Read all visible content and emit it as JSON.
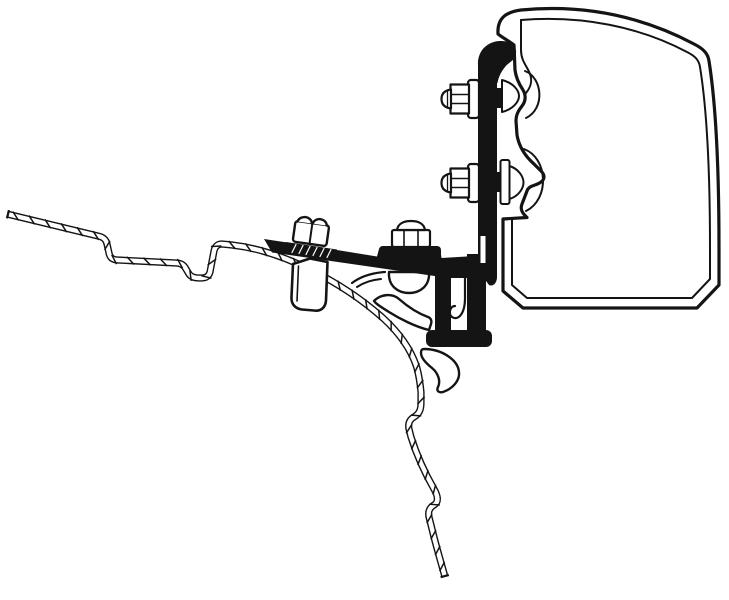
{
  "canvas": {
    "width": 729,
    "height": 600,
    "background": "#ffffff",
    "ink": "#141414",
    "paper": "#ffffff"
  },
  "diagram": {
    "type": "technical-line-drawing",
    "subject": "awning-adapter-bracket-cross-section",
    "hatch": {
      "spacing": 16.5,
      "tick_length": 10.5,
      "tick_width": 1.5,
      "outer_width": 7.2,
      "inner_width": 4.4,
      "cap_length": 8.5,
      "cap_width": 2.2
    },
    "parts": [
      {
        "name": "awning-cassette-outer-profile",
        "kind": "path",
        "fill": "paper",
        "sw": 3.2,
        "d": "M 498 34 C 497 18 506 12 521 10 C 585 4 643 17 694 44 C 704 49 708 54 709 61 C 716 105 719 168 719 248 L 719 285 L 697 308 L 523 308 L 503 291 L 503 219 L 527 217.5 C 522 213 520 209 522 204 L 527 191 C 529 185 536 186 541 182 C 545 179 545 175 541 171 L 534 164 C 525 156 519 147 517 135 L 516 121 C 516 114 519 110 522 106 C 526 101 526 95 523 90 C 519 84 516 78 515 70 L 514 45 C 509 41 503 38 498 34 Z"
      },
      {
        "name": "awning-cassette-inner-line",
        "kind": "path",
        "sw": 2,
        "d": "M 521 20 C 582 15 640 27 687 52 C 695 56 699 60 700 67 C 707 110 710 168 710 248 L 710 279 L 692 298 L 527 298 L 512 285 L 512 220"
      },
      {
        "name": "awning-cassette-left-inner-top-line",
        "kind": "path",
        "sw": 2,
        "d": "M 521 20 L 521 50 C 521 61 527 66 530 74 C 533 82 530 88 526 93"
      },
      {
        "name": "awning-rail-rib-upper",
        "kind": "path",
        "sw": 2,
        "d": "M 525 71 C 543 78 545 109 526 118"
      },
      {
        "name": "awning-rail-rib-lower",
        "kind": "path",
        "sw": 2,
        "d": "M 524 149 C 548 158 550 199 526 211"
      },
      {
        "name": "vehicle-roof-sheet-profile",
        "kind": "hatched",
        "d": "M 7 214 L 98 236 C 103 237 106 239 107 244 L 109 253 C 110 258 113 260 118 260 L 176 263 C 181 263 184 265 186 269 L 189 274 C 191 277 195 278 199 278 L 202 278 C 206 278 209 276 210 272 L 214 251 C 215 246 218 244 222 244 L 232 245 C 258 248 285 257 311 270 C 337 283 363 300 384 319 C 398 332 410 348 416 365 C 419 374 420 382 421 392 L 421 403 C 421 410 419 414 414 417 C 409 420 408 424 409 429 L 411 437 C 417 456 426 475 434 489 C 438 496 439 502 434 505 C 429 508 428 512 429 517 L 432 529 C 436 546 441 562 445 577"
      },
      {
        "name": "rail-bolt-shaft-upper",
        "kind": "rect",
        "x": 490,
        "y": 88,
        "w": 11,
        "h": 20,
        "fill": "ink"
      },
      {
        "name": "rail-bolt-shaft-lower",
        "kind": "rect",
        "x": 490,
        "y": 172,
        "w": 11,
        "h": 20,
        "fill": "ink"
      },
      {
        "name": "rail-bolt-head-dome-upper",
        "kind": "path",
        "fill": "paper",
        "sw": 2,
        "d": "M 502 80 C 514 83 519 91 519 96 C 519 101 514 109 502 112 Z"
      },
      {
        "name": "rail-bolt-washer-lower",
        "kind": "rect",
        "x": 500.5,
        "y": 160,
        "w": 9,
        "h": 44,
        "rx": 2,
        "fill": "paper",
        "sw": 2
      },
      {
        "name": "rail-bolt-head-dome-lower",
        "kind": "path",
        "fill": "paper",
        "sw": 2,
        "d": "M 509.5 166 C 519 169 523.5 177 523.5 182.5 C 523.5 188 519 196 509.5 199 Z"
      },
      {
        "name": "roof-rail-lip-line-outer",
        "kind": "path",
        "sw": 2.2,
        "d": "M 385 272 C 370 273 360 277 352 283"
      },
      {
        "name": "roof-rail-lip-line-inner",
        "kind": "path",
        "sw": 2,
        "d": "M 381 279 C 370 280 363 283 357 287"
      },
      {
        "name": "roof-rail-round-bead",
        "kind": "path",
        "fill": "paper",
        "sw": 2.4,
        "d": "M 389 272 C 388 286 398 293 409 293 C 420 293 430 286 429 272 Z"
      },
      {
        "name": "roof-rail-wing-profile",
        "kind": "path",
        "fill": "paper",
        "sw": 2.4,
        "d": "M 374 301 C 381 294 392 293 399 299 C 407 306 417 313 428 317 C 431 318 432 321 431 324 L 429 330 C 416 327 400 319 389 312 C 381 307 376 304 374 301 Z"
      },
      {
        "name": "roof-rail-teardrop-profile",
        "kind": "path",
        "fill": "paper",
        "sw": 2.4,
        "d": "M 424 349 C 442 349 458 360 459 372 C 460 381 452 389 443 392 C 439 393 436 391 438 387 C 441 381 438 373 432 368 C 427 364 421 358 421 353 C 421 350 422 349 424 349 Z"
      },
      {
        "name": "roof-bolt-shaft-cylinder",
        "kind": "path",
        "fill": "paper",
        "sw": 2.6,
        "d": "M 293 264 L 291.5 297 C 291 304 295 308.5 302 309.5 L 314 310.5 C 321 311.5 325.5 307.5 326 300.5 L 327.5 262 L 310 258.5 Z"
      },
      {
        "name": "roof-bolt-shaft-seam-line",
        "kind": "line",
        "x1": 298.5,
        "y1": 266,
        "x2": 297,
        "y2": 301,
        "sw": 1.6
      },
      {
        "name": "adapter-arm",
        "kind": "path",
        "fill": "ink",
        "d": "M 264 239 L 340 250.5 L 377 256.5 L 379 249 C 380 246.5 382 246 385 246.2 L 434 248.5 C 439 249 440.5 251 441 254.5 L 441.5 258 L 475 256 L 484 252 L 484 282 L 438 276.5 L 272 252.5 Z"
      },
      {
        "name": "roof-bolt-serrated-flange",
        "kind": "path",
        "fill": "ink",
        "d": "M 286 242 L 337 249.5 L 336 259 L 285 251.5 Z"
      },
      {
        "name": "serration-line-1",
        "kind": "line",
        "x1": 292,
        "y1": 252.5,
        "x2": 296,
        "y2": 244.5,
        "sw": 1.2,
        "stroke": "paper"
      },
      {
        "name": "serration-line-2",
        "kind": "line",
        "x1": 299,
        "y1": 253.5,
        "x2": 303,
        "y2": 245.5,
        "sw": 1.2,
        "stroke": "paper"
      },
      {
        "name": "serration-line-3",
        "kind": "line",
        "x1": 306,
        "y1": 254.5,
        "x2": 310,
        "y2": 246.5,
        "sw": 1.2,
        "stroke": "paper"
      },
      {
        "name": "serration-line-4",
        "kind": "line",
        "x1": 313,
        "y1": 255.5,
        "x2": 317,
        "y2": 247.5,
        "sw": 1.2,
        "stroke": "paper"
      },
      {
        "name": "serration-line-5",
        "kind": "line",
        "x1": 320,
        "y1": 256.5,
        "x2": 324,
        "y2": 248.5,
        "sw": 1.2,
        "stroke": "paper"
      },
      {
        "name": "serration-line-6",
        "kind": "line",
        "x1": 327,
        "y1": 257.5,
        "x2": 331,
        "y2": 249.5,
        "sw": 1.2,
        "stroke": "paper"
      },
      {
        "name": "roof-bolt-hex-nut-body",
        "kind": "rect",
        "x": 294,
        "y": 223,
        "w": 34,
        "h": 21,
        "rx": 3,
        "fill": "paper",
        "sw": 2.4,
        "transform": "rotate(8 311 233)"
      },
      {
        "name": "roof-bolt-hex-nut-facet-line",
        "kind": "line",
        "x1": 311,
        "y1": 223,
        "x2": 311,
        "y2": 244,
        "sw": 2,
        "transform": "rotate(8 311 233)"
      },
      {
        "name": "roof-bolt-hex-nut-crown",
        "kind": "path",
        "fill": "paper",
        "sw": 2.4,
        "transform": "rotate(8 311 233)",
        "d": "M 296 223.5 C 297 219.5 301 218 303.5 218 C 306 218 310 219.5 310.5 223.5 M 311.5 223.5 C 312 219.5 316 218 318.5 218 C 321 218 325 219.5 325.5 223.5"
      },
      {
        "name": "arm-bolt-flange-washer",
        "kind": "rect",
        "x": 379,
        "y": 246,
        "w": 62,
        "h": 13,
        "rx": 4,
        "fill": "ink"
      },
      {
        "name": "adapter-hook-inner-strip",
        "kind": "rect",
        "x": 435,
        "y": 266,
        "w": 16,
        "h": 70,
        "fill": "ink"
      },
      {
        "name": "rail-lip-clamp-gap",
        "kind": "rect",
        "x": 451,
        "y": 278,
        "w": 16,
        "h": 53,
        "fill": "paper"
      },
      {
        "name": "rail-lip-j-hook-line",
        "kind": "path",
        "sw": 2.2,
        "d": "M 465 278 L 465 298 C 465 314 458 321 452 317 C 448 314 450 306 455 306"
      },
      {
        "name": "adapter-hook-outer-strip",
        "kind": "rect",
        "x": 467,
        "y": 254,
        "w": 19,
        "h": 84,
        "fill": "ink"
      },
      {
        "name": "adapter-vertical-plate",
        "kind": "path",
        "fill": "ink",
        "d": "M 478 60 L 497 60 L 497 277 C 497 283 493 287 489 285 L 478 270 Z"
      },
      {
        "name": "adapter-plate-top-hook",
        "kind": "path",
        "fill": "ink",
        "d": "M 478 66 C 477 51 487 41.5 500 41 C 511 40.5 517 46 516 54 C 515.5 60 509 62 505 67 C 501 72 498.5 77 497.5 83 L 478 83 Z"
      },
      {
        "name": "adapter-hook-foot",
        "kind": "rect",
        "x": 426,
        "y": 330,
        "w": 66,
        "h": 17,
        "rx": 6,
        "fill": "ink"
      },
      {
        "name": "arm-plate-joint-slit",
        "kind": "rect",
        "x": 480.5,
        "y": 236,
        "w": 5,
        "h": 27,
        "fill": "paper"
      },
      {
        "name": "arm-bolt-hex-body",
        "kind": "rect",
        "x": 392,
        "y": 230,
        "w": 38,
        "h": 17,
        "rx": 2,
        "fill": "paper",
        "sw": 2.2
      },
      {
        "name": "arm-bolt-facet-line-left",
        "kind": "line",
        "x1": 404,
        "y1": 231,
        "x2": 404,
        "y2": 246.5,
        "sw": 1.6
      },
      {
        "name": "arm-bolt-facet-line-right",
        "kind": "line",
        "x1": 418,
        "y1": 231,
        "x2": 418,
        "y2": 246.5,
        "sw": 1.6
      },
      {
        "name": "arm-bolt-dome-cap",
        "kind": "path",
        "fill": "paper",
        "sw": 2.2,
        "d": "M 397 230 C 398 223.5 404 221 411 221 C 418 221 424 223.5 425 230 Z"
      },
      {
        "name": "plate-nut-upper-flange",
        "kind": "rect",
        "x": 468,
        "y": 80,
        "w": 11,
        "h": 38,
        "rx": 3,
        "fill": "paper",
        "sw": 2.2
      },
      {
        "name": "plate-nut-upper-hex",
        "kind": "rect",
        "x": 450.5,
        "y": 84.5,
        "w": 18.5,
        "h": 29,
        "fill": "paper",
        "sw": 2.2
      },
      {
        "name": "plate-nut-upper-facet-line-1",
        "kind": "line",
        "x1": 451.5,
        "y1": 94.5,
        "x2": 468.5,
        "y2": 94.5,
        "sw": 1.5
      },
      {
        "name": "plate-nut-upper-facet-line-2",
        "kind": "line",
        "x1": 451.5,
        "y1": 103.5,
        "x2": 468.5,
        "y2": 103.5,
        "sw": 1.5
      },
      {
        "name": "plate-nut-upper-dome-cap",
        "kind": "path",
        "fill": "paper",
        "sw": 2.2,
        "d": "M 451 89.5 C 444 90.5 441.5 94 441.5 99 C 441.5 104 444 107.5 451 108.5 Z"
      },
      {
        "name": "plate-nut-upper-cap-line",
        "kind": "line",
        "x1": 447.5,
        "y1": 91.5,
        "x2": 447.5,
        "y2": 106.5,
        "sw": 1.3
      },
      {
        "name": "plate-nut-lower-flange",
        "kind": "rect",
        "x": 468,
        "y": 164,
        "w": 11,
        "h": 38,
        "rx": 3,
        "fill": "paper",
        "sw": 2.2
      },
      {
        "name": "plate-nut-lower-hex",
        "kind": "rect",
        "x": 450.5,
        "y": 168.5,
        "w": 18.5,
        "h": 29,
        "fill": "paper",
        "sw": 2.2
      },
      {
        "name": "plate-nut-lower-facet-line-1",
        "kind": "line",
        "x1": 451.5,
        "y1": 178.5,
        "x2": 468.5,
        "y2": 178.5,
        "sw": 1.5
      },
      {
        "name": "plate-nut-lower-facet-line-2",
        "kind": "line",
        "x1": 451.5,
        "y1": 187.5,
        "x2": 468.5,
        "y2": 187.5,
        "sw": 1.5
      },
      {
        "name": "plate-nut-lower-dome-cap",
        "kind": "path",
        "fill": "paper",
        "sw": 2.2,
        "d": "M 451 173.5 C 444 174.5 441.5 178 441.5 183 C 441.5 188 444 191.5 451 192.5 Z"
      },
      {
        "name": "plate-nut-lower-cap-line",
        "kind": "line",
        "x1": 447.5,
        "y1": 175.5,
        "x2": 447.5,
        "y2": 190.5,
        "sw": 1.3
      }
    ]
  }
}
